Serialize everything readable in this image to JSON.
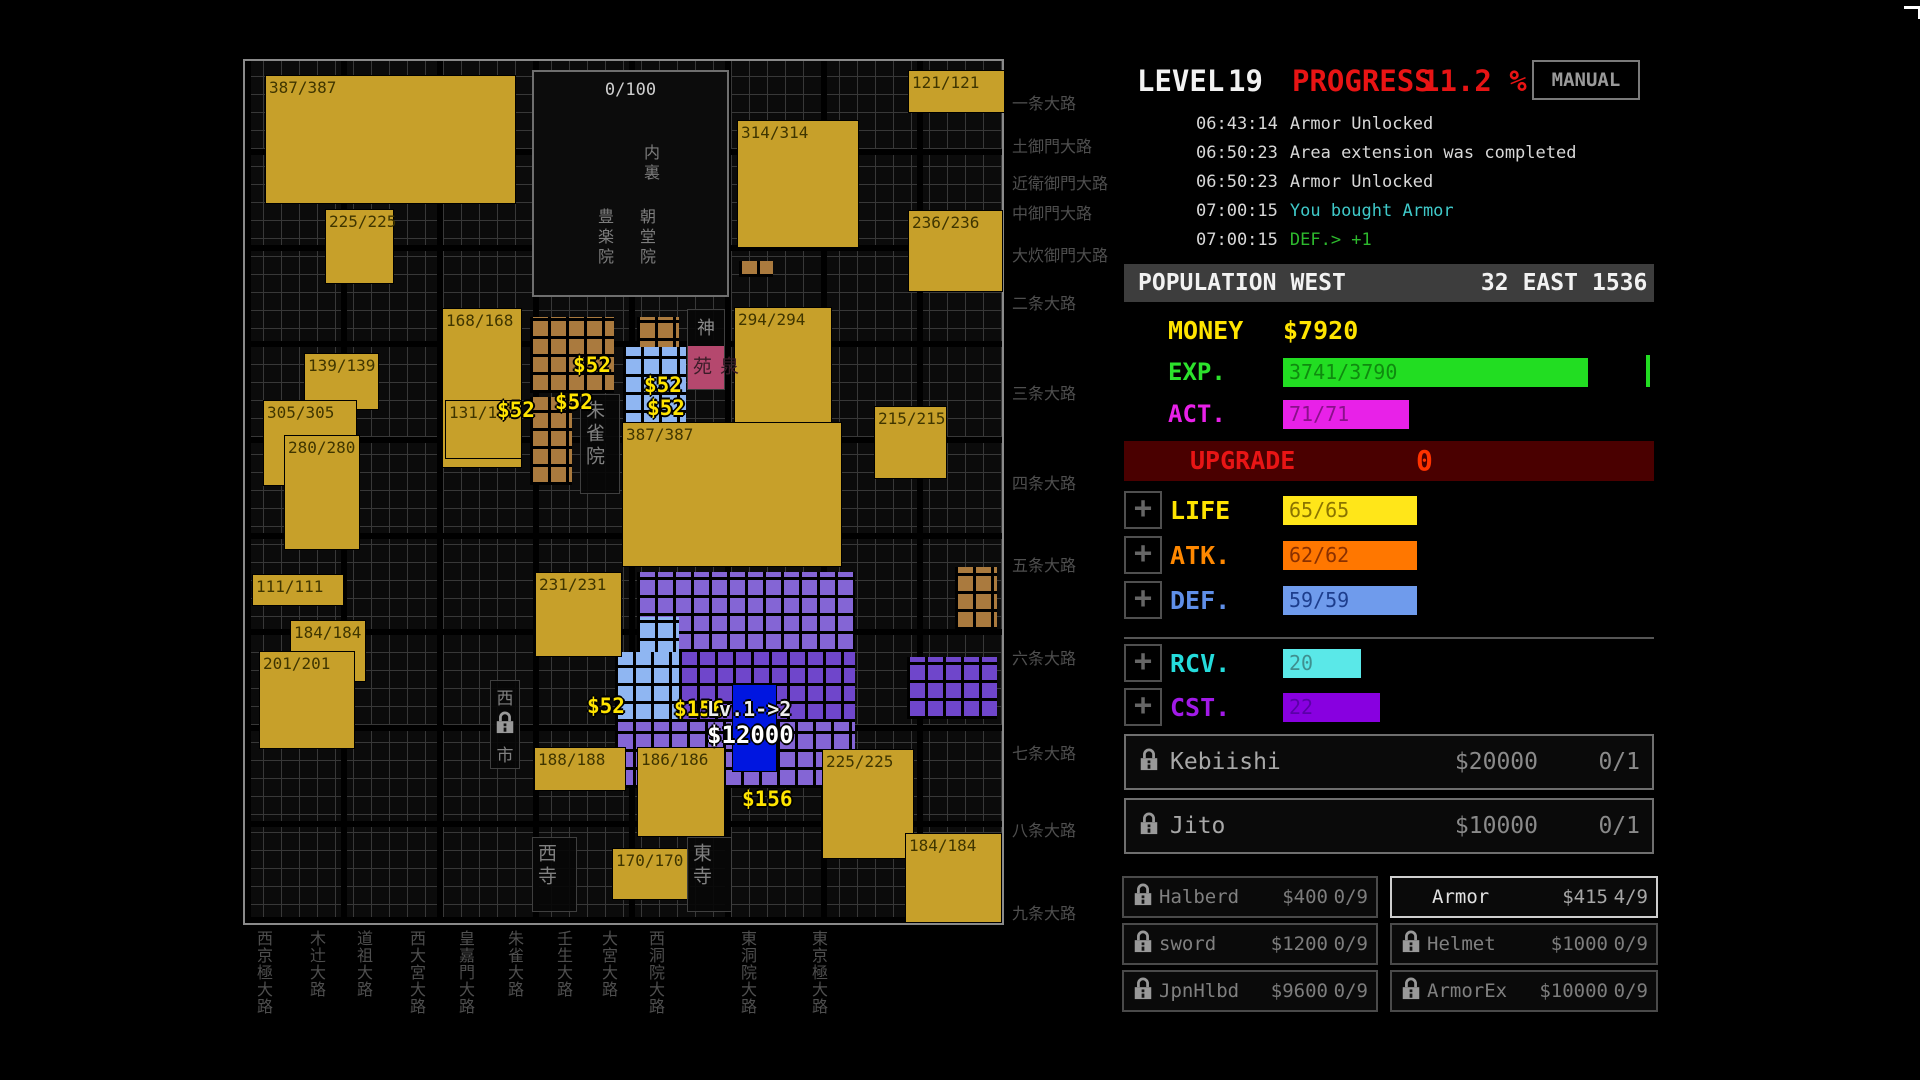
{
  "header": {
    "level_label": "LEVEL",
    "level_value": "19",
    "progress_label": "PROGRESS",
    "progress_value": "11.2 %",
    "manual_button": "MANUAL"
  },
  "log": {
    "entries": [
      {
        "time": "06:43:14",
        "message": "Armor Unlocked",
        "message_color": "#d8d8d8"
      },
      {
        "time": "06:50:23",
        "message": "Area extension was completed",
        "message_color": "#d8d8d8"
      },
      {
        "time": "06:50:23",
        "message": "Armor Unlocked",
        "message_color": "#d8d8d8"
      },
      {
        "time": "07:00:15",
        "message": "You bought Armor",
        "message_color": "#3fc9c9"
      },
      {
        "time": "07:00:15",
        "message": "DEF.> +1",
        "message_color": "#2db92d"
      }
    ]
  },
  "population": {
    "label": "POPULATION",
    "west_label": "WEST",
    "west_value": "32",
    "east_label": "EAST",
    "east_value": "1536"
  },
  "resources": {
    "money_label": "MONEY",
    "money_value": "$7920",
    "exp_label": "EXP.",
    "exp_value": "3741/3790",
    "act_label": "ACT.",
    "act_value": "71/71",
    "upgrade_label": "UPGRADE",
    "upgrade_value": "0"
  },
  "stats": [
    {
      "id": "life",
      "label": "LIFE",
      "value": "65/65",
      "label_color": "#ffe400",
      "bar_color": "#ffe619",
      "value_color": "#8a7400",
      "bar_w": 134
    },
    {
      "id": "atk",
      "label": "ATK.",
      "value": "62/62",
      "label_color": "#ff8800",
      "bar_color": "#ff7700",
      "value_color": "#8a3000",
      "bar_w": 134
    },
    {
      "id": "def",
      "label": "DEF.",
      "value": "59/59",
      "label_color": "#5f8fe8",
      "bar_color": "#6f9bec",
      "value_color": "#1d3d8c",
      "bar_w": 134
    },
    {
      "id": "rcv",
      "label": "RCV.",
      "value": "20",
      "label_color": "#25dcdc",
      "bar_color": "#5ae8e8",
      "value_color": "#3f8f8f",
      "bar_w": 78
    },
    {
      "id": "cst",
      "label": "CST.",
      "value": "22",
      "label_color": "#a21ae8",
      "bar_color": "#8800e0",
      "value_color": "#5a00a8",
      "bar_w": 97
    }
  ],
  "recruits": [
    {
      "id": "kebiishi",
      "name": "Kebiishi",
      "price": "$20000",
      "count": "0/1",
      "locked": true
    },
    {
      "id": "jito",
      "name": "Jito",
      "price": "$10000",
      "count": "0/1",
      "locked": true
    }
  ],
  "shop": {
    "left": [
      {
        "id": "halberd",
        "name": "Halberd",
        "price": "$400",
        "count": "0/9",
        "locked": true,
        "selected": false
      },
      {
        "id": "sword",
        "name": "sword",
        "price": "$1200",
        "count": "0/9",
        "locked": true,
        "selected": false
      },
      {
        "id": "jpnhlbd",
        "name": "JpnHlbd",
        "price": "$9600",
        "count": "0/9",
        "locked": true,
        "selected": false
      }
    ],
    "right": [
      {
        "id": "armor",
        "name": "Armor",
        "price": "$415",
        "count": "4/9",
        "locked": false,
        "selected": true
      },
      {
        "id": "helmet",
        "name": "Helmet",
        "price": "$1000",
        "count": "0/9",
        "locked": true,
        "selected": false
      },
      {
        "id": "armorex",
        "name": "ArmorEx",
        "price": "$10000",
        "count": "0/9",
        "locked": true,
        "selected": false
      }
    ]
  },
  "map": {
    "blocks": [
      {
        "label": "387/387",
        "x": 20,
        "y": 14,
        "w": 251,
        "h": 129
      },
      {
        "label": "225/225",
        "x": 80,
        "y": 148,
        "w": 69,
        "h": 75
      },
      {
        "label": "121/121",
        "x": 663,
        "y": 9,
        "w": 97,
        "h": 43
      },
      {
        "label": "314/314",
        "x": 492,
        "y": 59,
        "w": 122,
        "h": 128
      },
      {
        "label": "236/236",
        "x": 663,
        "y": 149,
        "w": 95,
        "h": 82
      },
      {
        "label": "168/168",
        "x": 197,
        "y": 247,
        "w": 80,
        "h": 160
      },
      {
        "label": "294/294",
        "x": 489,
        "y": 246,
        "w": 98,
        "h": 117
      },
      {
        "label": "139/139",
        "x": 59,
        "y": 292,
        "w": 75,
        "h": 57
      },
      {
        "label": "305/305",
        "x": 18,
        "y": 339,
        "w": 94,
        "h": 86
      },
      {
        "label": "215/215",
        "x": 629,
        "y": 345,
        "w": 73,
        "h": 73
      },
      {
        "label": "131/131",
        "x": 200,
        "y": 339,
        "w": 77,
        "h": 59
      },
      {
        "label": "280/280",
        "x": 39,
        "y": 374,
        "w": 76,
        "h": 115
      },
      {
        "label": "387/387",
        "x": 377,
        "y": 361,
        "w": 220,
        "h": 145
      },
      {
        "label": "231/231",
        "x": 290,
        "y": 511,
        "w": 87,
        "h": 85
      },
      {
        "label": "111/111",
        "x": 7,
        "y": 513,
        "w": 92,
        "h": 32
      },
      {
        "label": "184/184",
        "x": 45,
        "y": 559,
        "w": 76,
        "h": 62
      },
      {
        "label": "201/201",
        "x": 14,
        "y": 590,
        "w": 96,
        "h": 98
      },
      {
        "label": "188/188",
        "x": 289,
        "y": 686,
        "w": 92,
        "h": 44
      },
      {
        "label": "186/186",
        "x": 392,
        "y": 686,
        "w": 88,
        "h": 90
      },
      {
        "label": "225/225",
        "x": 577,
        "y": 688,
        "w": 92,
        "h": 110
      },
      {
        "label": "184/184",
        "x": 660,
        "y": 772,
        "w": 97,
        "h": 90
      },
      {
        "label": "170/170",
        "x": 367,
        "y": 787,
        "w": 78,
        "h": 52
      }
    ],
    "palace": {
      "count": "0/100",
      "dairi": "内裏",
      "left_hall": "豊楽院",
      "right_hall": "朝堂院",
      "x": 287,
      "y": 9,
      "w": 197,
      "h": 227
    },
    "landmarks": [
      {
        "id": "shinsenen",
        "chars": "神泉苑",
        "x": 442,
        "y": 248,
        "w": 38,
        "h": 81
      },
      {
        "id": "suzakuin",
        "chars": "朱雀院",
        "x": 335,
        "y": 333,
        "w": 40,
        "h": 100
      },
      {
        "id": "west-market",
        "chars": "西市",
        "x": 245,
        "y": 619,
        "w": 30,
        "h": 89
      },
      {
        "id": "west-temple",
        "chars": "西寺",
        "x": 287,
        "y": 776,
        "w": 45,
        "h": 75
      },
      {
        "id": "east-temple",
        "chars": "東寺",
        "x": 442,
        "y": 776,
        "w": 45,
        "h": 75
      }
    ],
    "clusters": [
      {
        "x": 285,
        "y": 256,
        "w": 84,
        "h": 76,
        "color": "brown"
      },
      {
        "x": 285,
        "y": 336,
        "w": 42,
        "h": 88,
        "color": "brown"
      },
      {
        "x": 392,
        "y": 256,
        "w": 42,
        "h": 42,
        "color": "brown"
      },
      {
        "x": 494,
        "y": 200,
        "w": 34,
        "h": 16,
        "color": "brown"
      },
      {
        "x": 710,
        "y": 506,
        "w": 42,
        "h": 63,
        "color": "brown"
      },
      {
        "x": 378,
        "y": 286,
        "w": 63,
        "h": 84,
        "color": "light_blue"
      },
      {
        "x": 494,
        "y": 286,
        "w": 42,
        "h": 42,
        "color": "light_blue"
      },
      {
        "x": 392,
        "y": 511,
        "w": 218,
        "h": 80,
        "color": "purple_a"
      },
      {
        "x": 392,
        "y": 556,
        "w": 42,
        "h": 42,
        "color": "light_blue"
      },
      {
        "x": 434,
        "y": 591,
        "w": 176,
        "h": 70,
        "color": "purple_b"
      },
      {
        "x": 370,
        "y": 591,
        "w": 64,
        "h": 70,
        "color": "light_blue"
      },
      {
        "x": 370,
        "y": 661,
        "w": 240,
        "h": 66,
        "color": "purple_a"
      },
      {
        "x": 662,
        "y": 596,
        "w": 90,
        "h": 62,
        "color": "purple_b"
      }
    ],
    "selected_tile": {
      "x": 487,
      "y": 623,
      "w": 43,
      "h": 86
    },
    "upgrade_tag": {
      "line1": "Lv.1->2",
      "line2": "$12000",
      "x": 462,
      "y": 636
    },
    "price_tags": [
      {
        "text": "$52",
        "x": 328,
        "y": 292,
        "style": "yellow"
      },
      {
        "text": "$52",
        "x": 252,
        "y": 337,
        "style": "yellow"
      },
      {
        "text": "$52",
        "x": 310,
        "y": 329,
        "style": "yellow"
      },
      {
        "text": "$52",
        "x": 399,
        "y": 312,
        "style": "yellow"
      },
      {
        "text": "$52",
        "x": 402,
        "y": 335,
        "style": "yellow"
      },
      {
        "text": "$52",
        "x": 342,
        "y": 633,
        "style": "yellow"
      },
      {
        "text": "$156",
        "x": 429,
        "y": 636,
        "style": "yellow"
      },
      {
        "text": "$156",
        "x": 497,
        "y": 726,
        "style": "yellow"
      }
    ],
    "avenues_ew": [
      {
        "name": "一条大路",
        "y": 90
      },
      {
        "name": "土御門大路",
        "y": 133
      },
      {
        "name": "近衛御門大路",
        "y": 170
      },
      {
        "name": "中御門大路",
        "y": 200
      },
      {
        "name": "大炊御門大路",
        "y": 242
      },
      {
        "name": "二条大路",
        "y": 290
      },
      {
        "name": "三条大路",
        "y": 380
      },
      {
        "name": "四条大路",
        "y": 470
      },
      {
        "name": "五条大路",
        "y": 552
      },
      {
        "name": "六条大路",
        "y": 645
      },
      {
        "name": "七条大路",
        "y": 740
      },
      {
        "name": "八条大路",
        "y": 817
      },
      {
        "name": "九条大路",
        "y": 900
      }
    ],
    "avenues_ns": [
      {
        "name": "西京極大路",
        "x": 251
      },
      {
        "name": "木辻大路",
        "x": 304
      },
      {
        "name": "道祖大路",
        "x": 351
      },
      {
        "name": "西大宮大路",
        "x": 404
      },
      {
        "name": "皇嘉門大路",
        "x": 453
      },
      {
        "name": "朱雀大路",
        "x": 502
      },
      {
        "name": "壬生大路",
        "x": 551
      },
      {
        "name": "大宮大路",
        "x": 596
      },
      {
        "name": "西洞院大路",
        "x": 643
      },
      {
        "name": "東洞院大路",
        "x": 735
      },
      {
        "name": "東京極大路",
        "x": 806
      }
    ]
  },
  "colors": {
    "gold": "#c7a02a",
    "brown": "#aa7a3e",
    "light_blue": "#8fb6f2",
    "purple_a": "#8465d5",
    "purple_b": "#6f46cb",
    "pink": "#b5486e",
    "selected_blue": "#0016e0",
    "progress_red": "#e81414",
    "money_yellow": "#ffe400",
    "exp_green": "#22dd22",
    "act_magenta": "#e821e8",
    "upgrade_dark_red": "#4a0000"
  }
}
